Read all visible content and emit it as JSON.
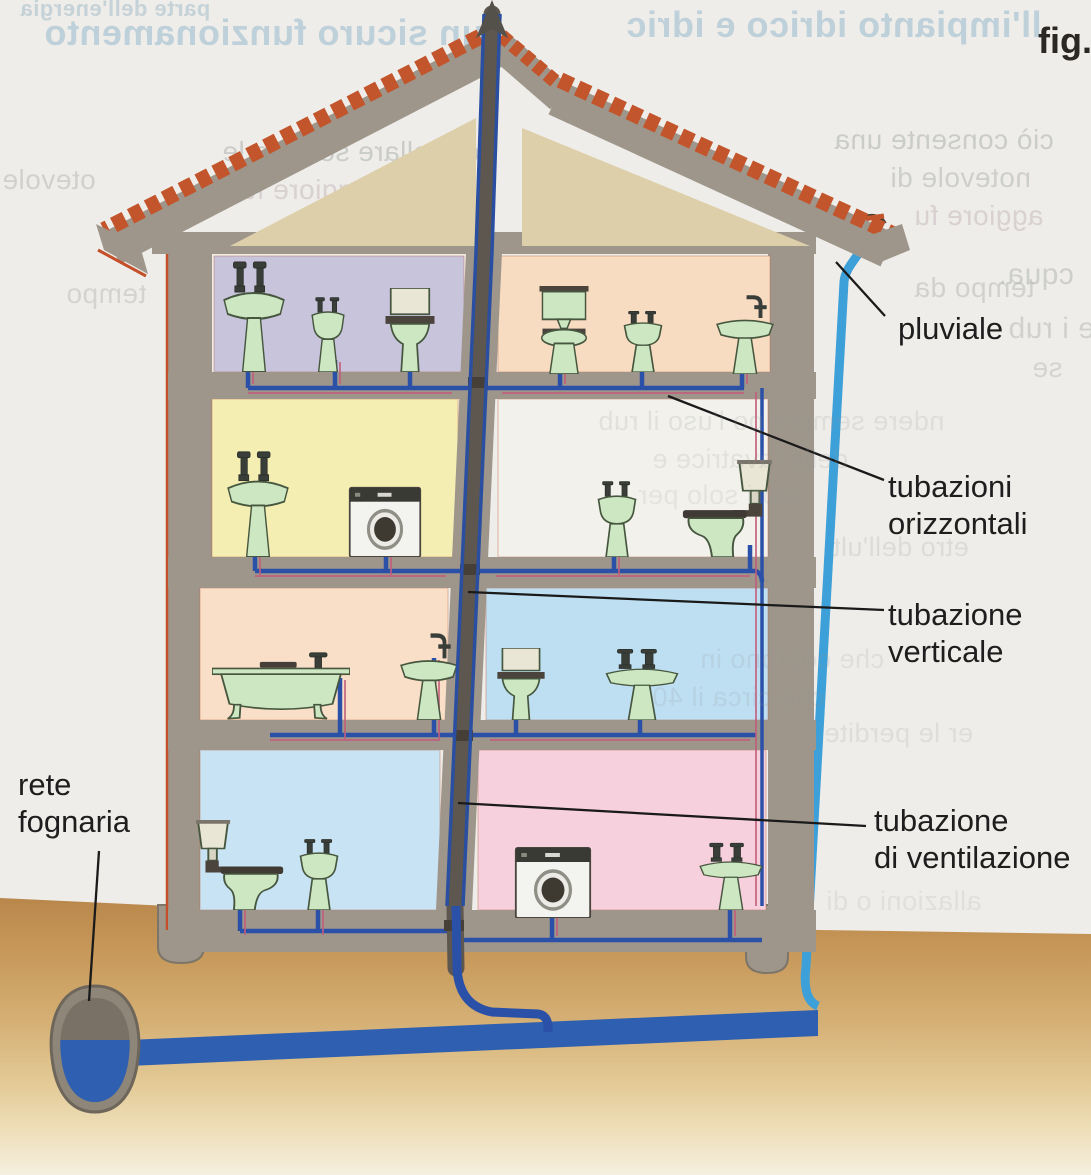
{
  "figure": {
    "caption": "fig."
  },
  "annotations": {
    "pluviale": {
      "text": "pluviale"
    },
    "tubazioni_orizzontali": {
      "line1": "tubazioni",
      "line2": "orizzontali"
    },
    "tubazione_verticale": {
      "line1": "tubazione",
      "line2": "verticale"
    },
    "tubazione_di_ventilazione": {
      "line1": "tubazione",
      "line2": "di ventilazione"
    },
    "rete_fognaria": {
      "line1": "rete",
      "line2": "fognaria"
    }
  },
  "diagram": {
    "type": "building-plumbing-cross-section",
    "subject": "impianto di scarico di un edificio a quattro piani",
    "floors": [
      {
        "level": 4,
        "rooms": [
          {
            "color_hex": "#c7c4dc",
            "fixtures": [
              "washbasin",
              "bidet",
              "toilet-with-tank"
            ]
          },
          {
            "color_hex": "#f8dcc2",
            "fixtures": [
              "toilet-with-high-tank",
              "bidet",
              "washbasin"
            ]
          }
        ]
      },
      {
        "level": 3,
        "rooms": [
          {
            "color_hex": "#f5eeb2",
            "fixtures": [
              "washbasin",
              "washing-machine"
            ]
          },
          {
            "color_hex": "#f2f1ec",
            "fixtures": [
              "bidet",
              "wall-tank-toilet"
            ]
          }
        ]
      },
      {
        "level": 2,
        "rooms": [
          {
            "color_hex": "#f9dfc8",
            "fixtures": [
              "bathtub",
              "washbasin"
            ]
          },
          {
            "color_hex": "#bedff2",
            "fixtures": [
              "toilet-with-tank",
              "washbasin"
            ]
          }
        ]
      },
      {
        "level": 1,
        "rooms": [
          {
            "color_hex": "#c8e3f3",
            "fixtures": [
              "wall-tank-toilet",
              "bidet"
            ]
          },
          {
            "color_hex": "#f6d0dd",
            "fixtures": [
              "washing-machine",
              "washbasin"
            ]
          }
        ]
      }
    ],
    "palette": {
      "wall": "#9e968b",
      "roof_tiles": "#c2552b",
      "attic": "#ddcfa9",
      "drain_pipe_blue": "#2a50a8",
      "hot_supply_red": "#c25c7a",
      "pluviale_light_blue": "#3da0d8",
      "sewer_blue": "#2e5fb0",
      "stack_grey": "#5d574f",
      "ground_brown": "#b9874b",
      "fixture_green": "#cde7c2",
      "page_background": "#efede9"
    }
  },
  "ghost_text": [
    {
      "text": "parte dell'energia",
      "x": 20,
      "y": -4,
      "size": 22,
      "color": "#9cb9c9",
      "bold": true,
      "opacity": 0.5
    },
    {
      "text": "un sicuro funzionamento",
      "x": 44,
      "y": 12,
      "size": 36,
      "color": "#8fb4cb",
      "bold": true,
      "opacity": 0.5
    },
    {
      "text": "ll'impianto idrico e idric",
      "x": 626,
      "y": 4,
      "size": 36,
      "color": "#8fb4cb",
      "bold": true,
      "opacity": 0.5
    },
    {
      "text": "ontrollare sempre le",
      "x": 222,
      "y": 136,
      "size": 28,
      "color": "#b3b7b4",
      "bold": false,
      "opacity": 0.6
    },
    {
      "text": "ciò consente una",
      "x": 834,
      "y": 124,
      "size": 28,
      "color": "#b3b7b4",
      "bold": false,
      "opacity": 0.6
    },
    {
      "text": "otevole",
      "x": 2,
      "y": 164,
      "size": 28,
      "color": "#b3b7b4",
      "bold": false,
      "opacity": 0.5
    },
    {
      "text": "notevole di",
      "x": 890,
      "y": 162,
      "size": 28,
      "color": "#b3b7b4",
      "bold": false,
      "opacity": 0.55
    },
    {
      "text": "aggiore fun",
      "x": 224,
      "y": 174,
      "size": 28,
      "color": "#c2b4ba",
      "bold": false,
      "opacity": 0.5
    },
    {
      "text": "aggiore fu",
      "x": 914,
      "y": 200,
      "size": 28,
      "color": "#c2b4ba",
      "bold": false,
      "opacity": 0.5
    },
    {
      "text": "cqua.",
      "x": 998,
      "y": 258,
      "size": 30,
      "color": "#b3b7b4",
      "bold": false,
      "opacity": 0.55
    },
    {
      "text": "tempo",
      "x": 66,
      "y": 278,
      "size": 28,
      "color": "#b3b7b4",
      "bold": false,
      "opacity": 0.45
    },
    {
      "text": "tempo da",
      "x": 914,
      "y": 272,
      "size": 28,
      "color": "#b3b7b4",
      "bold": false,
      "opacity": 0.5
    },
    {
      "text": "hiudere i rub",
      "x": 1008,
      "y": 312,
      "size": 30,
      "color": "#b3b7b4",
      "bold": false,
      "opacity": 0.5
    },
    {
      "text": "se",
      "x": 1032,
      "y": 352,
      "size": 28,
      "color": "#b3b7b4",
      "bold": false,
      "opacity": 0.45
    },
    {
      "text": "etro dell'ulti",
      "x": 826,
      "y": 532,
      "size": 27,
      "color": "#bec2be",
      "bold": false,
      "opacity": 0.4
    },
    {
      "text": "er le perdite",
      "x": 824,
      "y": 718,
      "size": 27,
      "color": "#bec2be",
      "bold": false,
      "opacity": 0.35
    },
    {
      "text": "allazioni o di",
      "x": 826,
      "y": 886,
      "size": 27,
      "color": "#bec2be",
      "bold": false,
      "opacity": 0.3
    },
    {
      "text": "ndere sempre  po l'uso il rub",
      "x": 598,
      "y": 406,
      "size": 27,
      "color": "#8e9496",
      "bold": false,
      "opacity": 0.17,
      "over": true
    },
    {
      "text": "della lavatrice e",
      "x": 652,
      "y": 444,
      "size": 27,
      "color": "#8e9496",
      "bold": false,
      "opacity": 0.16,
      "over": true
    },
    {
      "text": "atori solo per",
      "x": 638,
      "y": 480,
      "size": 27,
      "color": "#8e9496",
      "bold": false,
      "opacity": 0.14,
      "over": true
    },
    {
      "text": "che coprono in",
      "x": 700,
      "y": 644,
      "size": 27,
      "color": "#8e9496",
      "bold": false,
      "opacity": 0.16,
      "over": true
    },
    {
      "text": "che circa il 40",
      "x": 652,
      "y": 682,
      "size": 27,
      "color": "#8e9496",
      "bold": false,
      "opacity": 0.16,
      "over": true
    }
  ]
}
